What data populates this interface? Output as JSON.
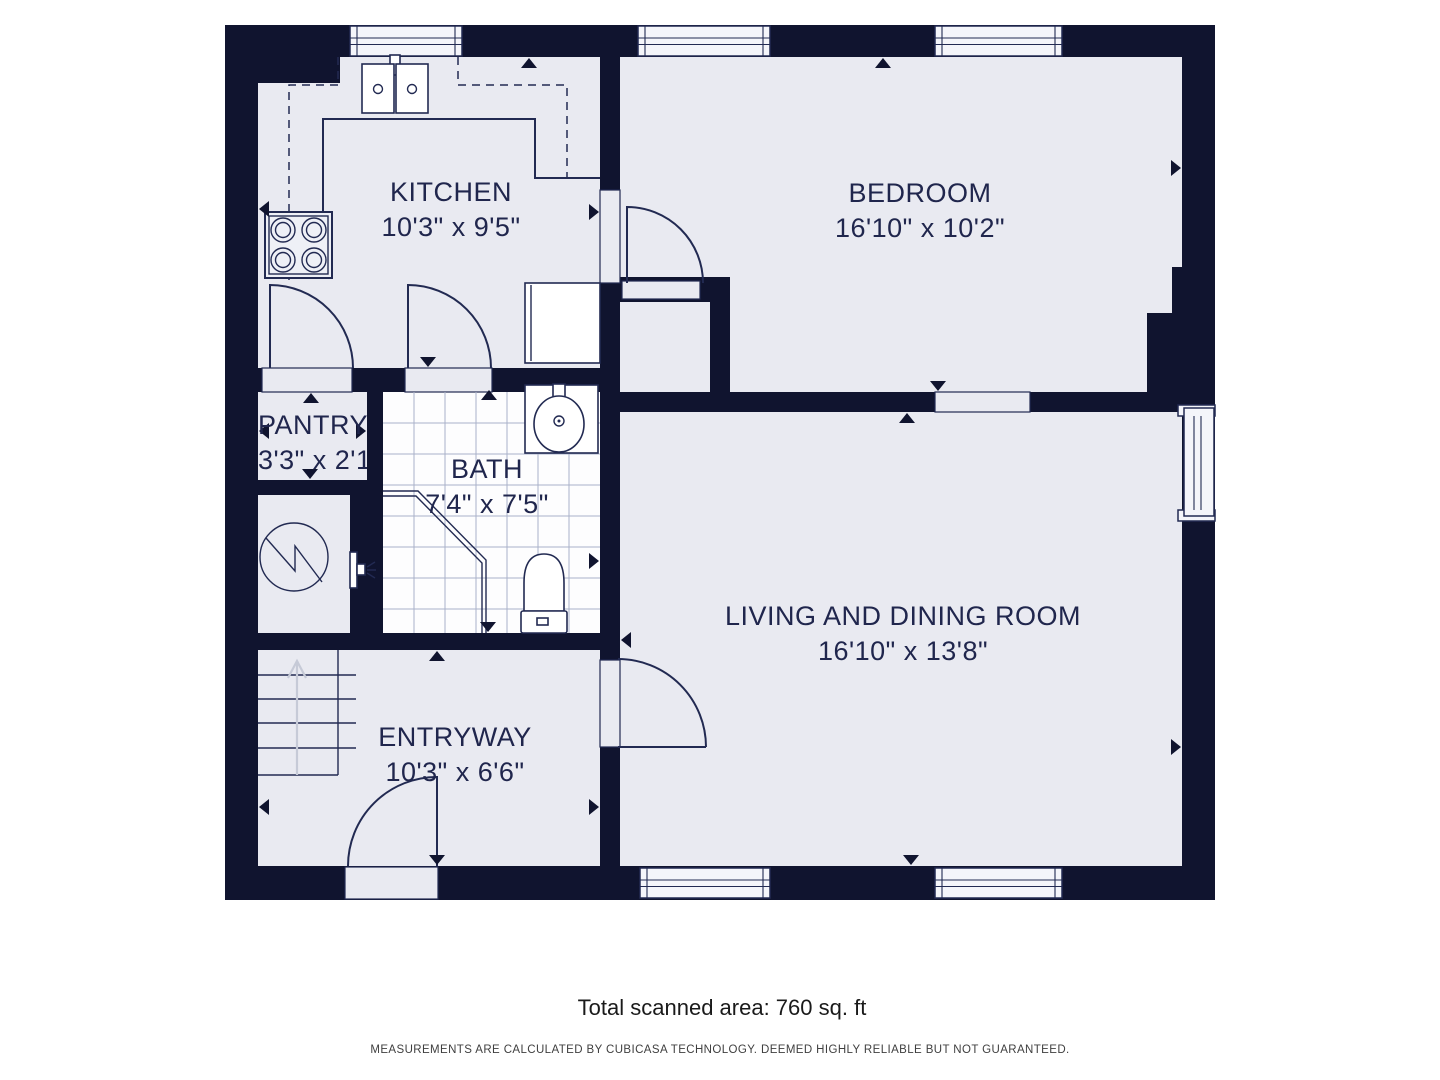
{
  "rooms": [
    {
      "id": "kitchen",
      "name": "KITCHEN",
      "dims": "10'3\" x 9'5\""
    },
    {
      "id": "bedroom",
      "name": "BEDROOM",
      "dims": "16'10\" x 10'2\""
    },
    {
      "id": "pantry",
      "name": "PANTRY",
      "dims": "3'3\" x 2'10\""
    },
    {
      "id": "bath",
      "name": "BATH",
      "dims": "7'4\" x 7'5\""
    },
    {
      "id": "living-dining",
      "name": "LIVING AND DINING ROOM",
      "dims": "16'10\" x 13'8\""
    },
    {
      "id": "entryway",
      "name": "ENTRYWAY",
      "dims": "10'3\" x 6'6\""
    }
  ],
  "footer": {
    "total_text": "Total scanned area: 760 sq. ft",
    "disclaimer_text": "MEASUREMENTS ARE CALCULATED BY CUBICASA TECHNOLOGY. DEEMED HIGHLY RELIABLE BUT NOT GUARANTEED."
  },
  "colors": {
    "wall": "#10142f",
    "floor": "#e9eaf1",
    "bath_floor": "#fdfdfe",
    "line": "#222a52",
    "tile_line": "#a9b1c9",
    "stairs_arrow": "#c6cad7",
    "label_text": "#20264d",
    "total_text": "#1a1a1a",
    "disclaimer_text": "#3f3f3f"
  }
}
